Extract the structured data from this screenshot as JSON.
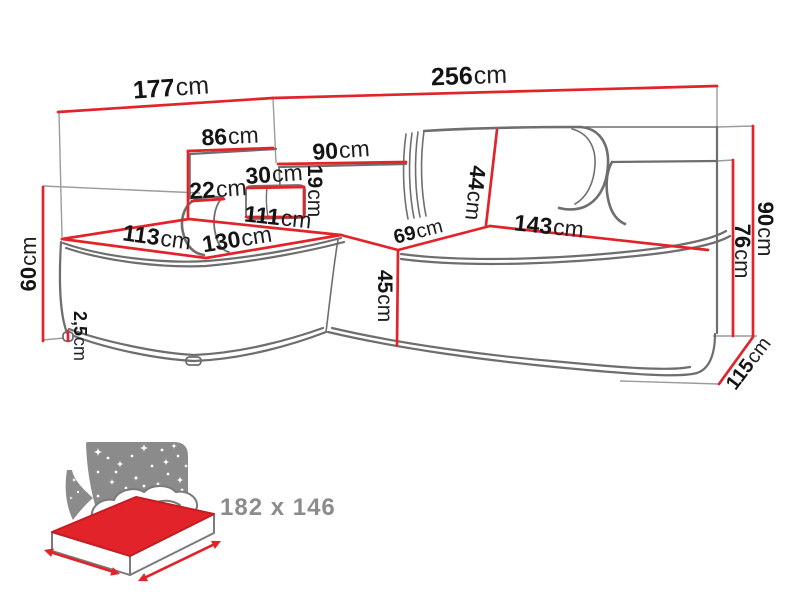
{
  "title": "Corner sofa dimensions diagram",
  "colors": {
    "dimension_red": "#e2232a",
    "outline_gray": "#6e6e6e",
    "reference_gray": "#9c9c9c",
    "label_black": "#141414",
    "icon_gray": "#8b8b8b"
  },
  "dimensions": {
    "chaise_depth": {
      "value": "177",
      "unit": "cm"
    },
    "total_width": {
      "value": "256",
      "unit": "cm"
    },
    "left_backrest_width": {
      "value": "86",
      "unit": "cm"
    },
    "mid_backrest_width": {
      "value": "90",
      "unit": "cm"
    },
    "headrest_width": {
      "value": "30",
      "unit": "cm"
    },
    "headrest_height": {
      "value": "19",
      "unit": "cm"
    },
    "armrest_width": {
      "value": "22",
      "unit": "cm"
    },
    "chaise_back_length": {
      "value": "111",
      "unit": "cm"
    },
    "chaise_front_width": {
      "value": "113",
      "unit": "cm"
    },
    "chaise_side_length": {
      "value": "130",
      "unit": "cm"
    },
    "seat_depth": {
      "value": "69",
      "unit": "cm"
    },
    "seat_width": {
      "value": "143",
      "unit": "cm"
    },
    "backrest_height": {
      "value": "44",
      "unit": "cm"
    },
    "total_height": {
      "value": "90",
      "unit": "cm"
    },
    "right_arm_height": {
      "value": "76",
      "unit": "cm"
    },
    "side_depth": {
      "value": "115",
      "unit": "cm"
    },
    "left_arm_height": {
      "value": "60",
      "unit": "cm"
    },
    "front_height": {
      "value": "45",
      "unit": "cm"
    },
    "leg_height": {
      "value": "2,5",
      "unit": "cm"
    }
  },
  "sleeping_area": {
    "label": "182 x 146"
  }
}
